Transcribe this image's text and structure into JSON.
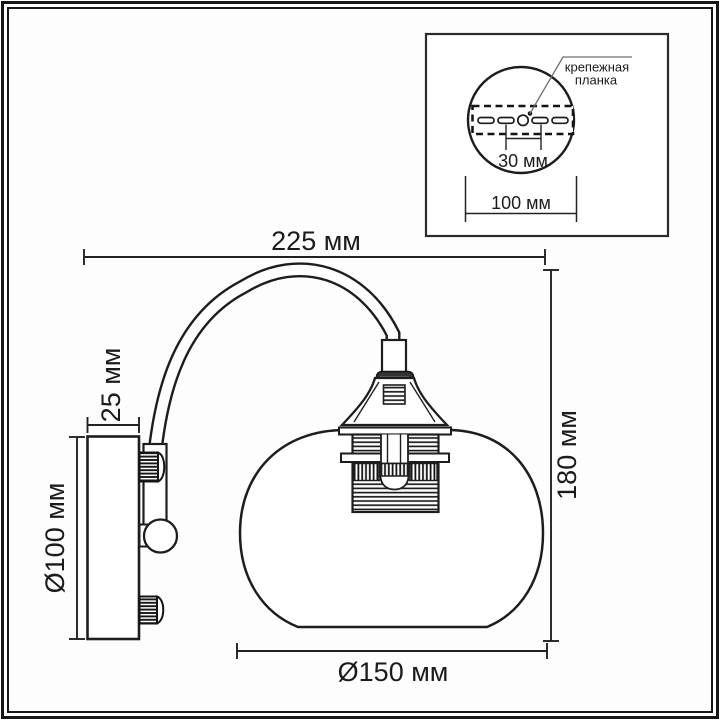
{
  "drawing": {
    "type": "wall-sconce-technical-drawing",
    "dimensions": {
      "overall_width": "225 мм",
      "overall_height": "180 мм",
      "plate_depth": "25 мм",
      "plate_diameter": "Ø100 мм",
      "shade_diameter": "Ø150 мм"
    },
    "inset": {
      "label_line1": "крепежная",
      "label_line2": "планка",
      "slot_spacing": "30 мм",
      "plate_width": "100 мм"
    },
    "colors": {
      "ink": "#1d1d1d",
      "background": "#fdfdfd",
      "collar_fill": "#333333",
      "leader_line": "#6f6f6f"
    }
  }
}
